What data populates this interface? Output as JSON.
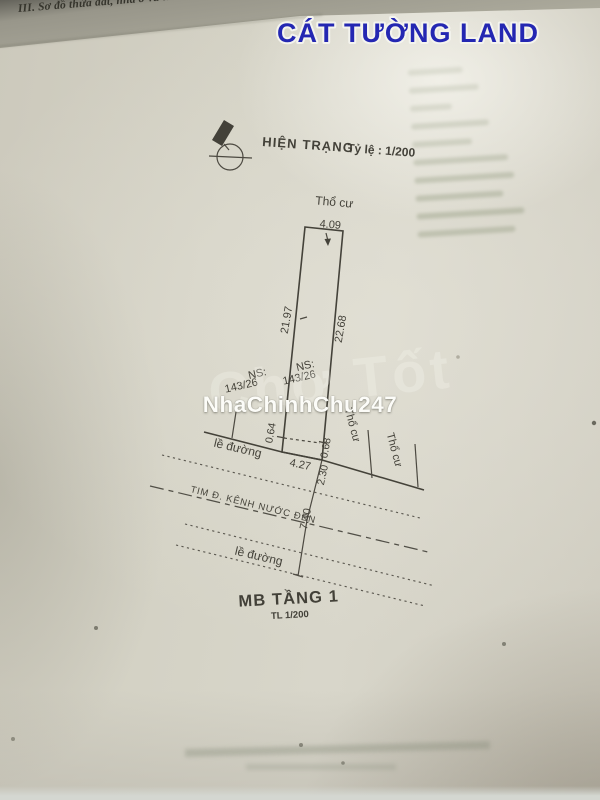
{
  "page": {
    "header_line": "III. Sơ đồ thửa đất, nhà ở và tài sản khác gắ",
    "brand": "CÁT TƯỜNG LAND",
    "watermark": "NhaChinhChu247",
    "watermark_bg": "Chợ Tốt"
  },
  "drawing": {
    "status_title": "HIỆN TRẠNG",
    "scale_text": "Tỷ lệ : 1/200",
    "land_type": "Thổ cư",
    "parcel": {
      "ns_label": "NS:",
      "ns_value": "143/26"
    },
    "dims": {
      "top_width": "4.09",
      "left_length": "21.97",
      "right_length": "22.68",
      "left_offset": "0.64",
      "right_offset": "0.68",
      "bottom_width": "4.27",
      "to_centerline": "2.30",
      "centerline_to_curb": "7.40"
    },
    "road": {
      "edge_label": "lề đường",
      "center_label": "TIM Đ. KÊNH NƯỚC ĐEN"
    },
    "caption": {
      "title": "MB TẦNG 1",
      "scale": "TL 1/200"
    }
  },
  "colors": {
    "brand_blue": "#2427b2",
    "ink": "#3d3b33",
    "paper": "#d5d3c7"
  }
}
